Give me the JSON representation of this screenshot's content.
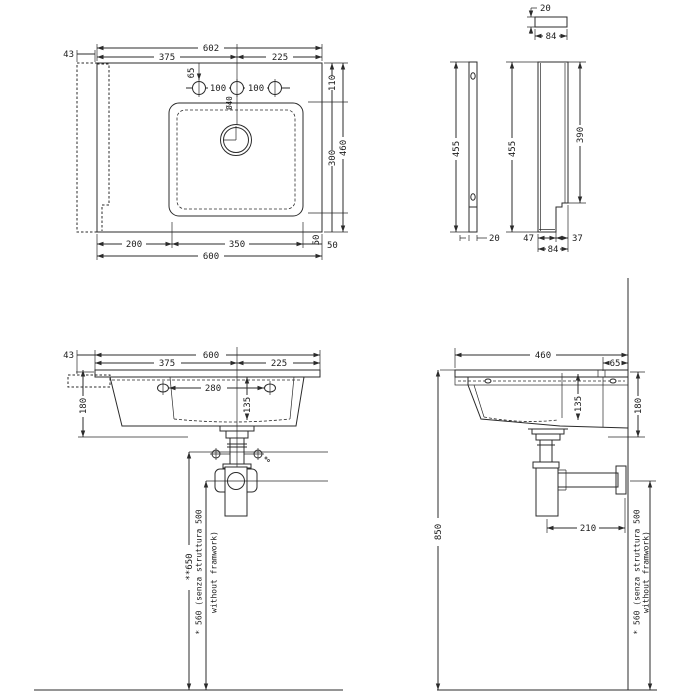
{
  "drawing_title": "wall-hung washbasin technical drawing",
  "plan": {
    "d43": "43",
    "d602": "602",
    "d375": "375",
    "d225": "225",
    "d65": "65",
    "d100a": "100",
    "d100b": "100",
    "d40": "Ø40",
    "d110": "110",
    "d300": "300",
    "d50v": "50",
    "d460": "460",
    "d200": "200",
    "d350": "350",
    "d50h": "50",
    "d600": "600"
  },
  "bracket": {
    "t20": "20",
    "t84": "84",
    "f455": "455",
    "f20": "20",
    "s455": "455",
    "s390": "390",
    "s47": "47",
    "s37": "37",
    "s84": "84"
  },
  "front": {
    "d43": "43",
    "d600": "600",
    "d375": "375",
    "d225": "225",
    "d280": "280",
    "d135": "135",
    "d180": "180",
    "d650": "**650",
    "d560a": "* 560 (senza struttura 500",
    "d560b": "without framwork)"
  },
  "side": {
    "d460": "460",
    "d65": "65",
    "d135": "135",
    "d180": "180",
    "d850": "850",
    "d210": "210",
    "d560a": "* 560 (senza struttura 500",
    "d560b": "without framwork)"
  }
}
